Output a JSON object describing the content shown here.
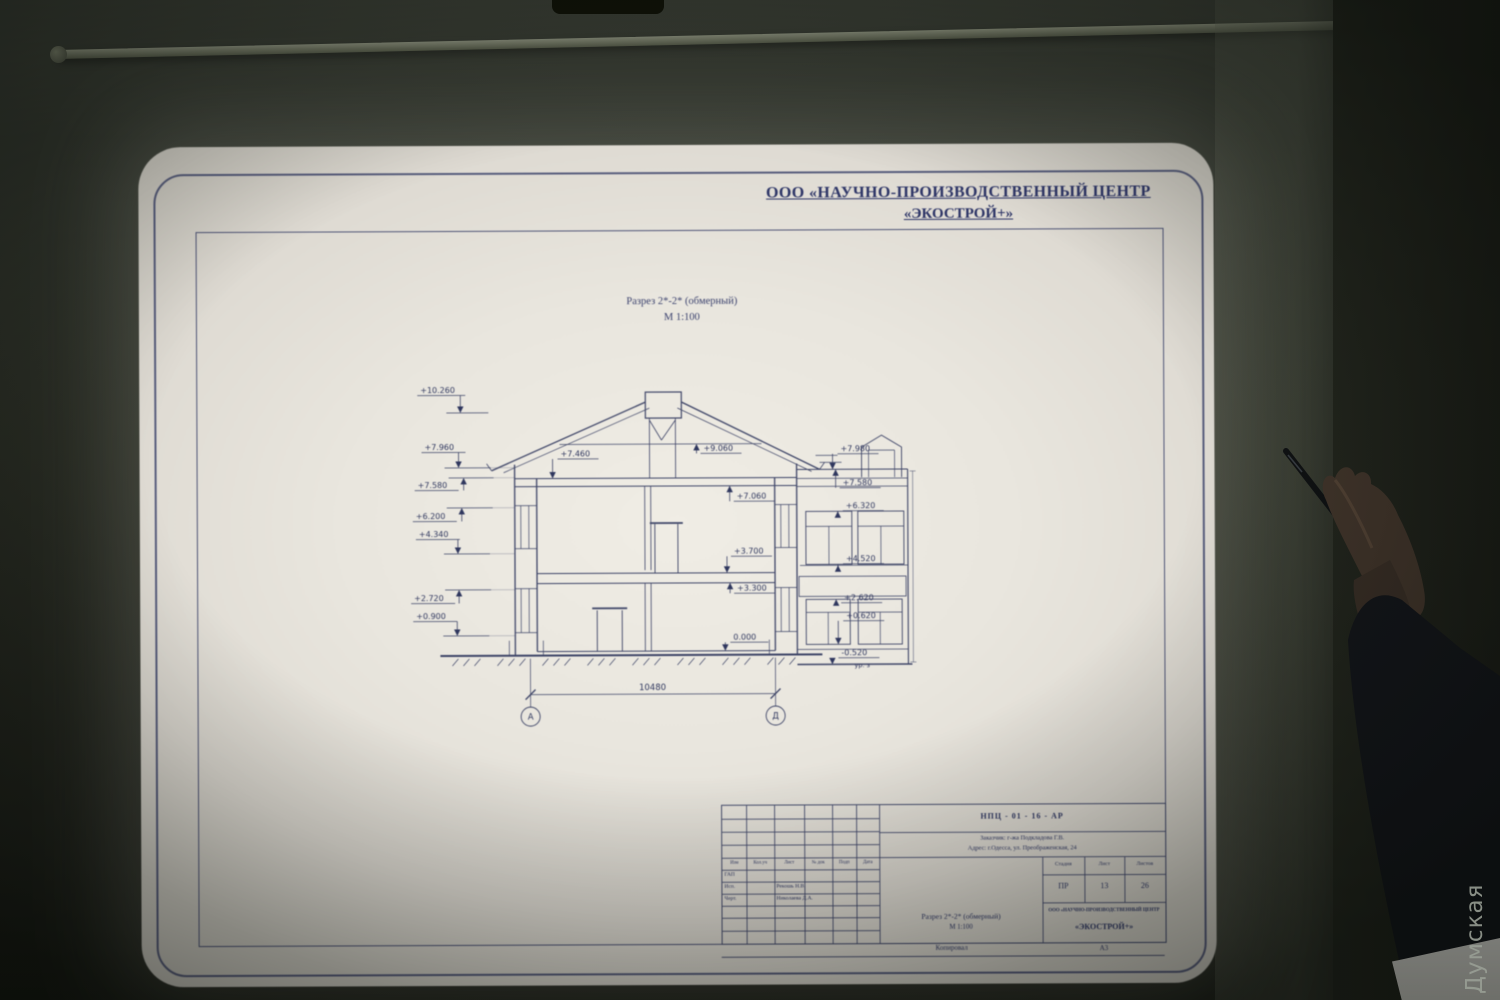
{
  "photo": {
    "watermark": "Думская"
  },
  "sheet": {
    "org_header_line1": "ООО «НАУЧНО-ПРОИЗВОДСТВЕННЫЙ ЦЕНТР",
    "org_header_line2": "«ЭКОСТРОЙ+»",
    "caption_title": "Разрез 2*-2* (обмерный)",
    "caption_scale": "М 1:100"
  },
  "section": {
    "left_marks": [
      "+10.260",
      "+7.960",
      "+7.580",
      "+6.200",
      "+4.340",
      "+2.720",
      "+0.900"
    ],
    "interior_marks": {
      "attic_left": "+7.460",
      "ridge": "+9.060",
      "ceiling_2nd": "+7.060",
      "level_2nd_top": "+3.700",
      "slab_2nd": "+3.300",
      "ground_floor": "0.000"
    },
    "facade_marks": [
      "+7.980",
      "+7.580",
      "+6.320",
      "+4.520",
      "+2.620",
      "+0.620",
      "-0.520"
    ],
    "ground_level_label": "ур. з",
    "total_dimension": "10480",
    "axis_left": "А",
    "axis_right": "Д"
  },
  "title_block": {
    "doc_code": "НПЦ - 01 - 16 - АР",
    "customer_line": "Заказчик:  г-жа  Подкладова  Г.В.",
    "address_line": "Адрес:  г.Одесса,  ул.  Преображенская,  24",
    "header_cols": [
      "Изм",
      "Кол.уч",
      "Лист",
      "№ док",
      "Подп",
      "Дата"
    ],
    "staff_rows": [
      {
        "role": "ГАП",
        "name": ""
      },
      {
        "role": "Исп.",
        "name": "Рекошь Н.В."
      },
      {
        "role": "Черт.",
        "name": "Николаева Д.А."
      }
    ],
    "drawing_title": "Разрез 2*-2* (обмерный)",
    "drawing_scale": "М 1:100",
    "stage_label": "Стадия",
    "sheet_label": "Лист",
    "sheets_label": "Листов",
    "stage_value": "ПР",
    "sheet_value": "13",
    "sheets_value": "26",
    "org_line1": "ООО «НАУЧНО-ПРОИЗВОДСТВЕННЫЙ ЦЕНТР",
    "org_line2": "«ЭКОСТРОЙ+»",
    "copied_label": "Копировал",
    "format_label": "А3"
  }
}
